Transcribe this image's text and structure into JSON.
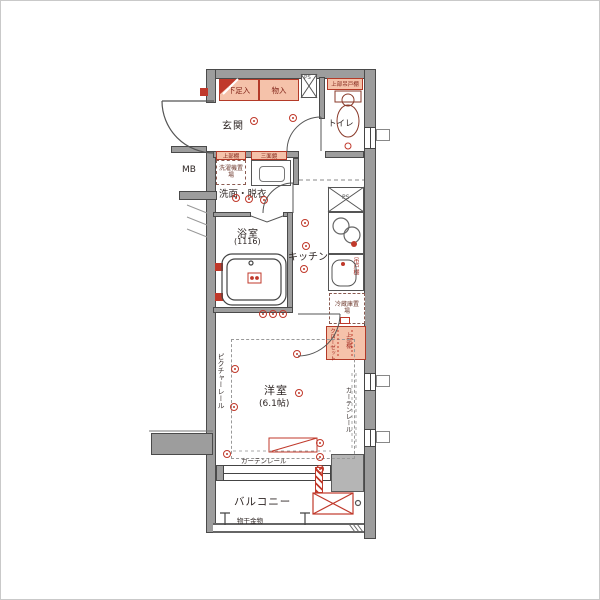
{
  "floorplan": {
    "labels": {
      "genkan": "玄関",
      "toilet": "トイレ",
      "washroom": "洗面・脱衣",
      "bathroom": "浴室",
      "bathroom_size": "(1116)",
      "kitchen": "キッチン",
      "room": "洋室",
      "room_size": "(6.1帖)",
      "balcony": "バルコニー",
      "shoe_box": "下足入",
      "storage": "物入",
      "ps_top": "PS",
      "ps_kitchen": "PS",
      "mb": "MB",
      "toilet_shelf": "上部吊戸棚",
      "washer_shelf": "上部棚",
      "mirror": "三面鏡",
      "washer": "洗濯機置場",
      "hanging_cupboard": "吊戸棚",
      "fridge": "冷蔵庫置場",
      "closet": "クローゼット",
      "closet_shelf": "上部棚",
      "picture_rail": "ピクチャーレール",
      "curtain_rail_side": "カーテンレール",
      "curtain_rail_bottom": "カーテンレール",
      "laundry": "物干金物"
    },
    "colors": {
      "wall": "#9d9d9d",
      "accent_red": "#c0392b",
      "cabinet_fill": "#f5c2aa"
    }
  }
}
